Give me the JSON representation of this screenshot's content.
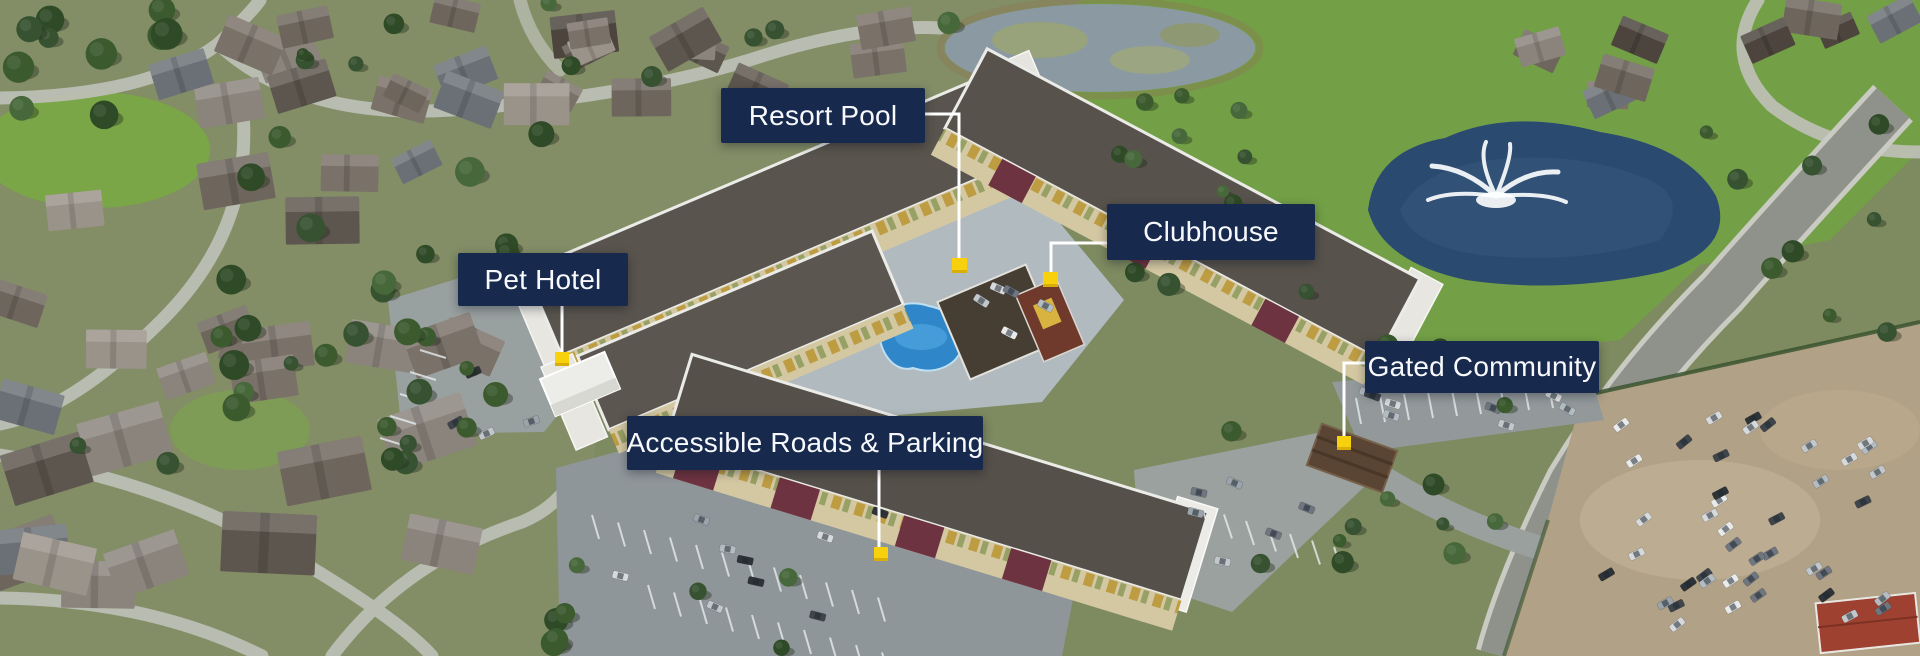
{
  "map": {
    "description_colors": {
      "callout_bg": "#18294E",
      "callout_text": "#F7F9FC",
      "marker_fill": "#F7D10E",
      "connector_line": "#FFFFFF"
    },
    "callouts": [
      {
        "id": "resort-pool",
        "label": "Resort Pool"
      },
      {
        "id": "clubhouse",
        "label": "Clubhouse"
      },
      {
        "id": "pet-hotel",
        "label": "Pet Hotel"
      },
      {
        "id": "gated-community",
        "label": "Gated Community"
      },
      {
        "id": "accessible-roads",
        "label": "Accessible Roads & Parking"
      }
    ]
  }
}
